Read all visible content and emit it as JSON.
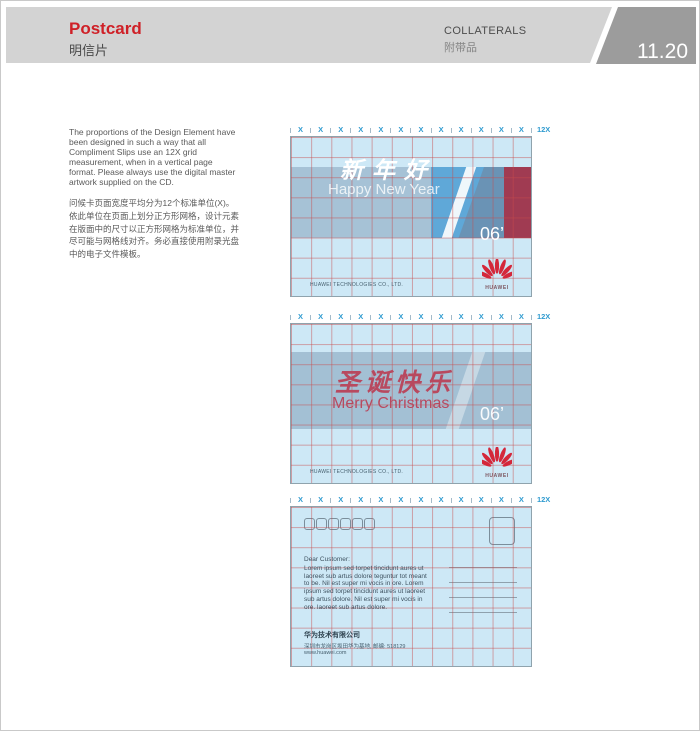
{
  "header": {
    "title_en": "Postcard",
    "title_zh": "明信片",
    "section_en": "COLLATERALS",
    "section_zh": "附带品",
    "page_number": "11.20"
  },
  "intro": {
    "en": "The proportions of the Design Element have been designed in such a way that all Compliment Slips use an 12X grid measurement, when in a vertical page format. Please always use the digital master artwork supplied on the CD.",
    "zh": "问候卡页面宽度平均分为12个标准单位(X)。依此单位在页面上划分正方形网格，设计元素在版面中的尺寸以正方形网格为标准单位，并尽可能与网格线对齐。务必直接使用附录光盘中的电子文件模板。"
  },
  "ruler": {
    "unit_label": "X",
    "unit_count": 12,
    "total_label": "12X"
  },
  "cards": {
    "new_year": {
      "headline_zh": "新年好",
      "headline_en": "Happy New Year",
      "year_label": "06’",
      "company_line": "HUAWEI TECHNOLOGIES CO., LTD.",
      "logo_text": "HUAWEI"
    },
    "christmas": {
      "headline_zh": "圣诞快乐",
      "headline_en": "Merry Christmas",
      "year_label": "06’",
      "company_line": "HUAWEI TECHNOLOGIES CO., LTD.",
      "logo_text": "HUAWEI"
    },
    "back": {
      "salutation": "Dear Customer:",
      "body": "Lorem ipsum sed torpet tincidunt aures ut laoreet sub artus dolore teguntur tot meant to be. Nil est super mi vocis in ore. Lorem ipsum sed torpet tincidunt aures ut laoreet sub artus dolore. Nil est super mi vocis in ore. laoreet sub artus dolore.",
      "company_zh": "华为技术有限公司",
      "address_zh": "深圳市龙岗区坂田华为基地, 邮编: 518129",
      "website": "www.huawei.com",
      "postal_box_count": 6,
      "address_line_count": 4
    }
  },
  "colors": {
    "accent_red": "#cf2027",
    "ruler_blue": "#2f9bd0",
    "card_bg": "#cde8f6",
    "grid_line": "#c84b4b",
    "band_gray_blue": "#a6c2d6",
    "bright_blue": "#5fa8d8",
    "medium_blue": "#6a93b5",
    "maroon": "#a03b52",
    "holiday_red": "#b8495f",
    "logo_red": "#d4273a"
  }
}
